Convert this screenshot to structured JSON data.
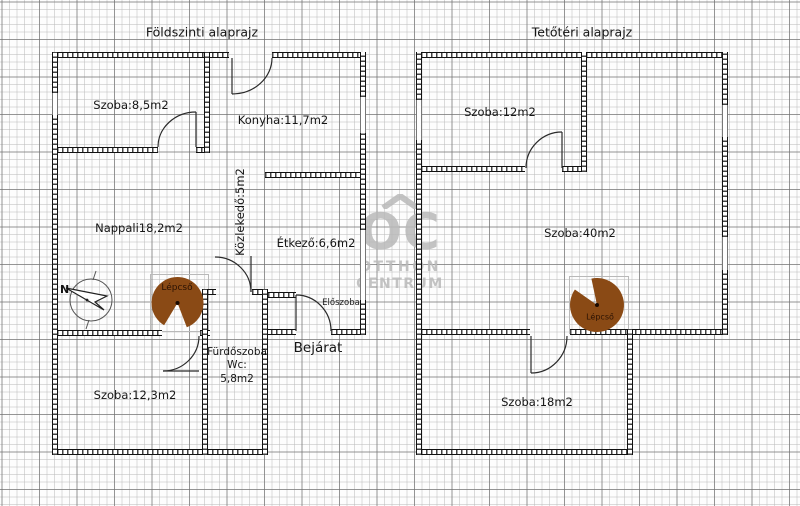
{
  "ground": {
    "title": "Földszinti alaprajz",
    "labels": {
      "szoba85": "Szoba:8,5m2",
      "konyha": "Konyha:11,7m2",
      "kozlekedo": "Közlekedő:5m2",
      "nappali": "Nappali18,2m2",
      "etkezo": "Étkező:6,6m2",
      "lepcso": "Lépcső",
      "furdoszoba_line1": "Fürdőszoba",
      "furdoszoba_line2": "Wc:",
      "furdoszoba_line3": "5,8m2",
      "bejarat": "Bejárat",
      "eloszoba": "Előszoba",
      "szoba123": "Szoba:12,3m2"
    }
  },
  "attic": {
    "title": "Tetőtéri alaprajz",
    "labels": {
      "szoba12": "Szoba:12m2",
      "szoba40": "Szoba:40m2",
      "lepcso": "Lépcső",
      "szoba18": "Szoba:18m2"
    }
  },
  "watermark": {
    "logo": "OC",
    "line1": "OTTHON",
    "line2": "CENTRUM"
  },
  "compass": {
    "north": "N"
  },
  "colors": {
    "wall": "#1a1a1a",
    "stairs_fill": "#8a4a15",
    "stairs_label": "#2a1203",
    "watermark": "#b9b9b9",
    "grid_minor": "#d9d9d9",
    "grid_major": "#8e8e8e"
  }
}
